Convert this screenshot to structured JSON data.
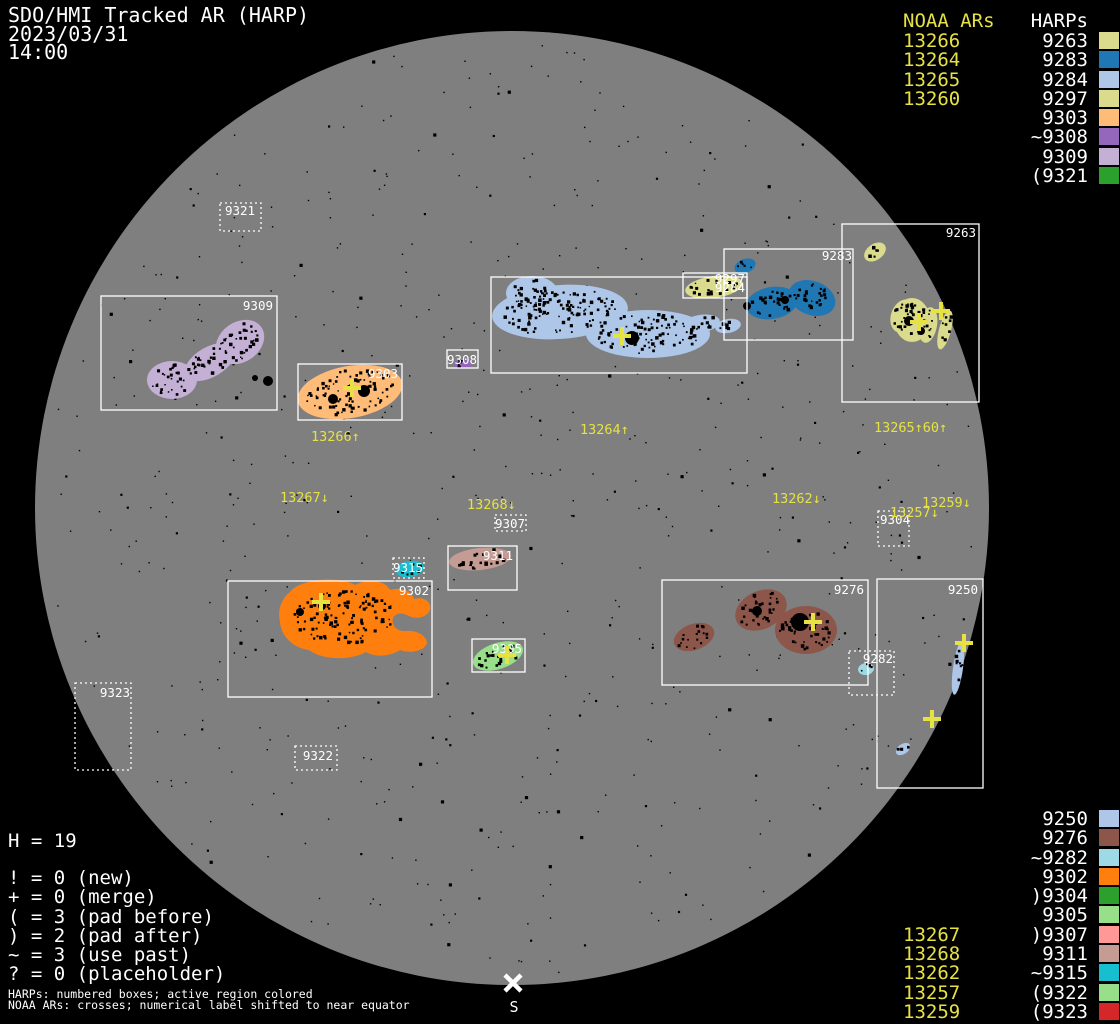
{
  "title": {
    "app": "SDO/HMI Tracked AR (HARP)",
    "date": "2023/03/31",
    "time": "14:00"
  },
  "legend_top_right": {
    "noaa_header": "NOAA ARs",
    "harp_header": "HARPs",
    "rows": [
      {
        "noaa": "13266",
        "harp": "9263",
        "color": "#dbdb8d"
      },
      {
        "noaa": "13264",
        "harp": "9283",
        "color": "#1f77b4"
      },
      {
        "noaa": "13265",
        "harp": "9284",
        "color": "#aec7e8"
      },
      {
        "noaa": "13260",
        "harp": "9297",
        "color": "#dbdb8d"
      },
      {
        "noaa": "",
        "harp": "9303",
        "color": "#ffbb78"
      },
      {
        "noaa": "",
        "harp": "~9308",
        "color": "#9467bd"
      },
      {
        "noaa": "",
        "harp": "9309",
        "color": "#c5b0d5"
      },
      {
        "noaa": "",
        "harp": "(9321",
        "color": "#2ca02c"
      }
    ]
  },
  "legend_bottom_right": {
    "rows": [
      {
        "noaa": "",
        "harp": "9250",
        "color": "#aec7e8"
      },
      {
        "noaa": "",
        "harp": "9276",
        "color": "#8c564b"
      },
      {
        "noaa": "",
        "harp": "~9282",
        "color": "#9edae5"
      },
      {
        "noaa": "",
        "harp": "9302",
        "color": "#ff7f0e"
      },
      {
        "noaa": "",
        "harp": ")9304",
        "color": "#2ca02c"
      },
      {
        "noaa": "",
        "harp": "9305",
        "color": "#98df8a"
      },
      {
        "noaa": "13267",
        "harp": ")9307",
        "color": "#ff9896"
      },
      {
        "noaa": "13268",
        "harp": "9311",
        "color": "#c49c94"
      },
      {
        "noaa": "13262",
        "harp": "~9315",
        "color": "#17becf"
      },
      {
        "noaa": "13257",
        "harp": "(9322",
        "color": "#98df8a"
      },
      {
        "noaa": "13259",
        "harp": "(9323",
        "color": "#d62728"
      }
    ]
  },
  "stats": {
    "harp_count": "H = 19",
    "flags": [
      "! = 0 (new)",
      "+ = 0 (merge)",
      "( = 3 (pad before)",
      ") = 2 (pad after)",
      "~ = 3 (use past)",
      "? = 0 (placeholder)"
    ]
  },
  "footer": {
    "line1": "HARPs: numbered boxes; active region colored",
    "line2": "NOAA ARs: crosses; numerical label shifted to near equator"
  },
  "south_marker": "S",
  "colors": {
    "background": "#000000",
    "disk": "#7f7f7f",
    "annotation": "#ffffff",
    "noaa_yellow": "#e6e243"
  },
  "disk": {
    "cx": 512,
    "cy": 508,
    "r": 477
  },
  "regions": [
    {
      "harp": "9321",
      "style": "dotted",
      "box": [
        220,
        203,
        41,
        28
      ],
      "color": "#2ca02c",
      "label": {
        "x": 240,
        "y": 215,
        "anchor": "middle"
      }
    },
    {
      "harp": "9309",
      "style": "solid",
      "box": [
        101,
        296,
        176,
        114
      ],
      "color": "#c5b0d5",
      "label": {
        "x": 273,
        "y": 310,
        "anchor": "end"
      }
    },
    {
      "harp": "9303",
      "style": "solid",
      "box": [
        298,
        364,
        104,
        56
      ],
      "color": "#ffbb78",
      "label": {
        "x": 398,
        "y": 378,
        "anchor": "end"
      }
    },
    {
      "harp": "9308",
      "style": "solid",
      "box": [
        447,
        350,
        31,
        18
      ],
      "color": "#9467bd",
      "label": {
        "x": 462,
        "y": 364,
        "anchor": "middle"
      }
    },
    {
      "harp": "9284",
      "style": "solid",
      "box": [
        491,
        277,
        256,
        96
      ],
      "color": "#aec7e8",
      "label": {
        "x": 745,
        "y": 292,
        "anchor": "end"
      }
    },
    {
      "harp": "9297",
      "style": "solid",
      "box": [
        683,
        273,
        64,
        25
      ],
      "color": "#dbdb8d",
      "label": {
        "x": 745,
        "y": 283,
        "anchor": "end"
      }
    },
    {
      "harp": "9283",
      "style": "solid",
      "box": [
        724,
        249,
        129,
        91
      ],
      "color": "#1f77b4",
      "label": {
        "x": 852,
        "y": 260,
        "anchor": "end"
      }
    },
    {
      "harp": "9263",
      "style": "solid",
      "box": [
        842,
        224,
        137,
        178
      ],
      "color": "#dbdb8d",
      "label": {
        "x": 976,
        "y": 237,
        "anchor": "end"
      }
    },
    {
      "harp": "9304",
      "style": "dotted",
      "box": [
        878,
        511,
        31,
        35
      ],
      "color": "#2ca02c",
      "label": {
        "x": 880,
        "y": 524,
        "anchor": "start"
      }
    },
    {
      "harp": "9307",
      "style": "dotted",
      "box": [
        495,
        515,
        31,
        16
      ],
      "color": "#ff9896",
      "label": {
        "x": 510,
        "y": 528,
        "anchor": "middle"
      }
    },
    {
      "harp": "9315",
      "style": "dotted",
      "box": [
        393,
        558,
        31,
        20
      ],
      "color": "#17becf",
      "label": {
        "x": 408,
        "y": 572,
        "anchor": "middle"
      }
    },
    {
      "harp": "9311",
      "style": "solid",
      "box": [
        448,
        546,
        69,
        44
      ],
      "color": "#c49c94",
      "label": {
        "x": 513,
        "y": 560,
        "anchor": "end"
      }
    },
    {
      "harp": "9302",
      "style": "solid",
      "box": [
        228,
        581,
        204,
        116
      ],
      "color": "#ff7f0e",
      "label": {
        "x": 429,
        "y": 595,
        "anchor": "end"
      }
    },
    {
      "harp": "9305",
      "style": "solid",
      "box": [
        472,
        639,
        53,
        33
      ],
      "color": "#98df8a",
      "label": {
        "x": 522,
        "y": 653,
        "anchor": "end"
      }
    },
    {
      "harp": "9276",
      "style": "solid",
      "box": [
        662,
        580,
        206,
        105
      ],
      "color": "#8c564b",
      "label": {
        "x": 864,
        "y": 594,
        "anchor": "end"
      }
    },
    {
      "harp": "9282",
      "style": "dotted",
      "box": [
        849,
        651,
        45,
        44
      ],
      "color": "#9edae5",
      "label": {
        "x": 893,
        "y": 663,
        "anchor": "end"
      }
    },
    {
      "harp": "9250",
      "style": "solid",
      "box": [
        877,
        579,
        106,
        209
      ],
      "color": "#aec7e8",
      "label": {
        "x": 978,
        "y": 594,
        "anchor": "end"
      }
    },
    {
      "harp": "9322",
      "style": "dotted",
      "box": [
        295,
        746,
        42,
        24
      ],
      "color": "#98df8a",
      "label": {
        "x": 333,
        "y": 760,
        "anchor": "end"
      }
    },
    {
      "harp": "9323",
      "style": "dotted",
      "box": [
        75,
        683,
        56,
        87
      ],
      "color": "#d62728",
      "label": {
        "x": 130,
        "y": 697,
        "anchor": "end"
      }
    }
  ],
  "ar_labels": [
    {
      "text": "13266↑",
      "x": 311,
      "y": 441
    },
    {
      "text": "13264↑",
      "x": 580,
      "y": 434
    },
    {
      "text": "13265↑60↑",
      "x": 874,
      "y": 432
    },
    {
      "text": "13267↓",
      "x": 280,
      "y": 502
    },
    {
      "text": "13268↓",
      "x": 467,
      "y": 509
    },
    {
      "text": "13262↓",
      "x": 772,
      "y": 503
    },
    {
      "text": "13257↓",
      "x": 890,
      "y": 517
    },
    {
      "text": "13259↓",
      "x": 922,
      "y": 507
    }
  ],
  "crosses": [
    [
      352,
      388
    ],
    [
      622,
      336
    ],
    [
      919,
      322
    ],
    [
      941,
      311
    ],
    [
      321,
      602
    ],
    [
      507,
      655
    ],
    [
      813,
      622
    ],
    [
      964,
      643
    ],
    [
      932,
      719
    ]
  ]
}
